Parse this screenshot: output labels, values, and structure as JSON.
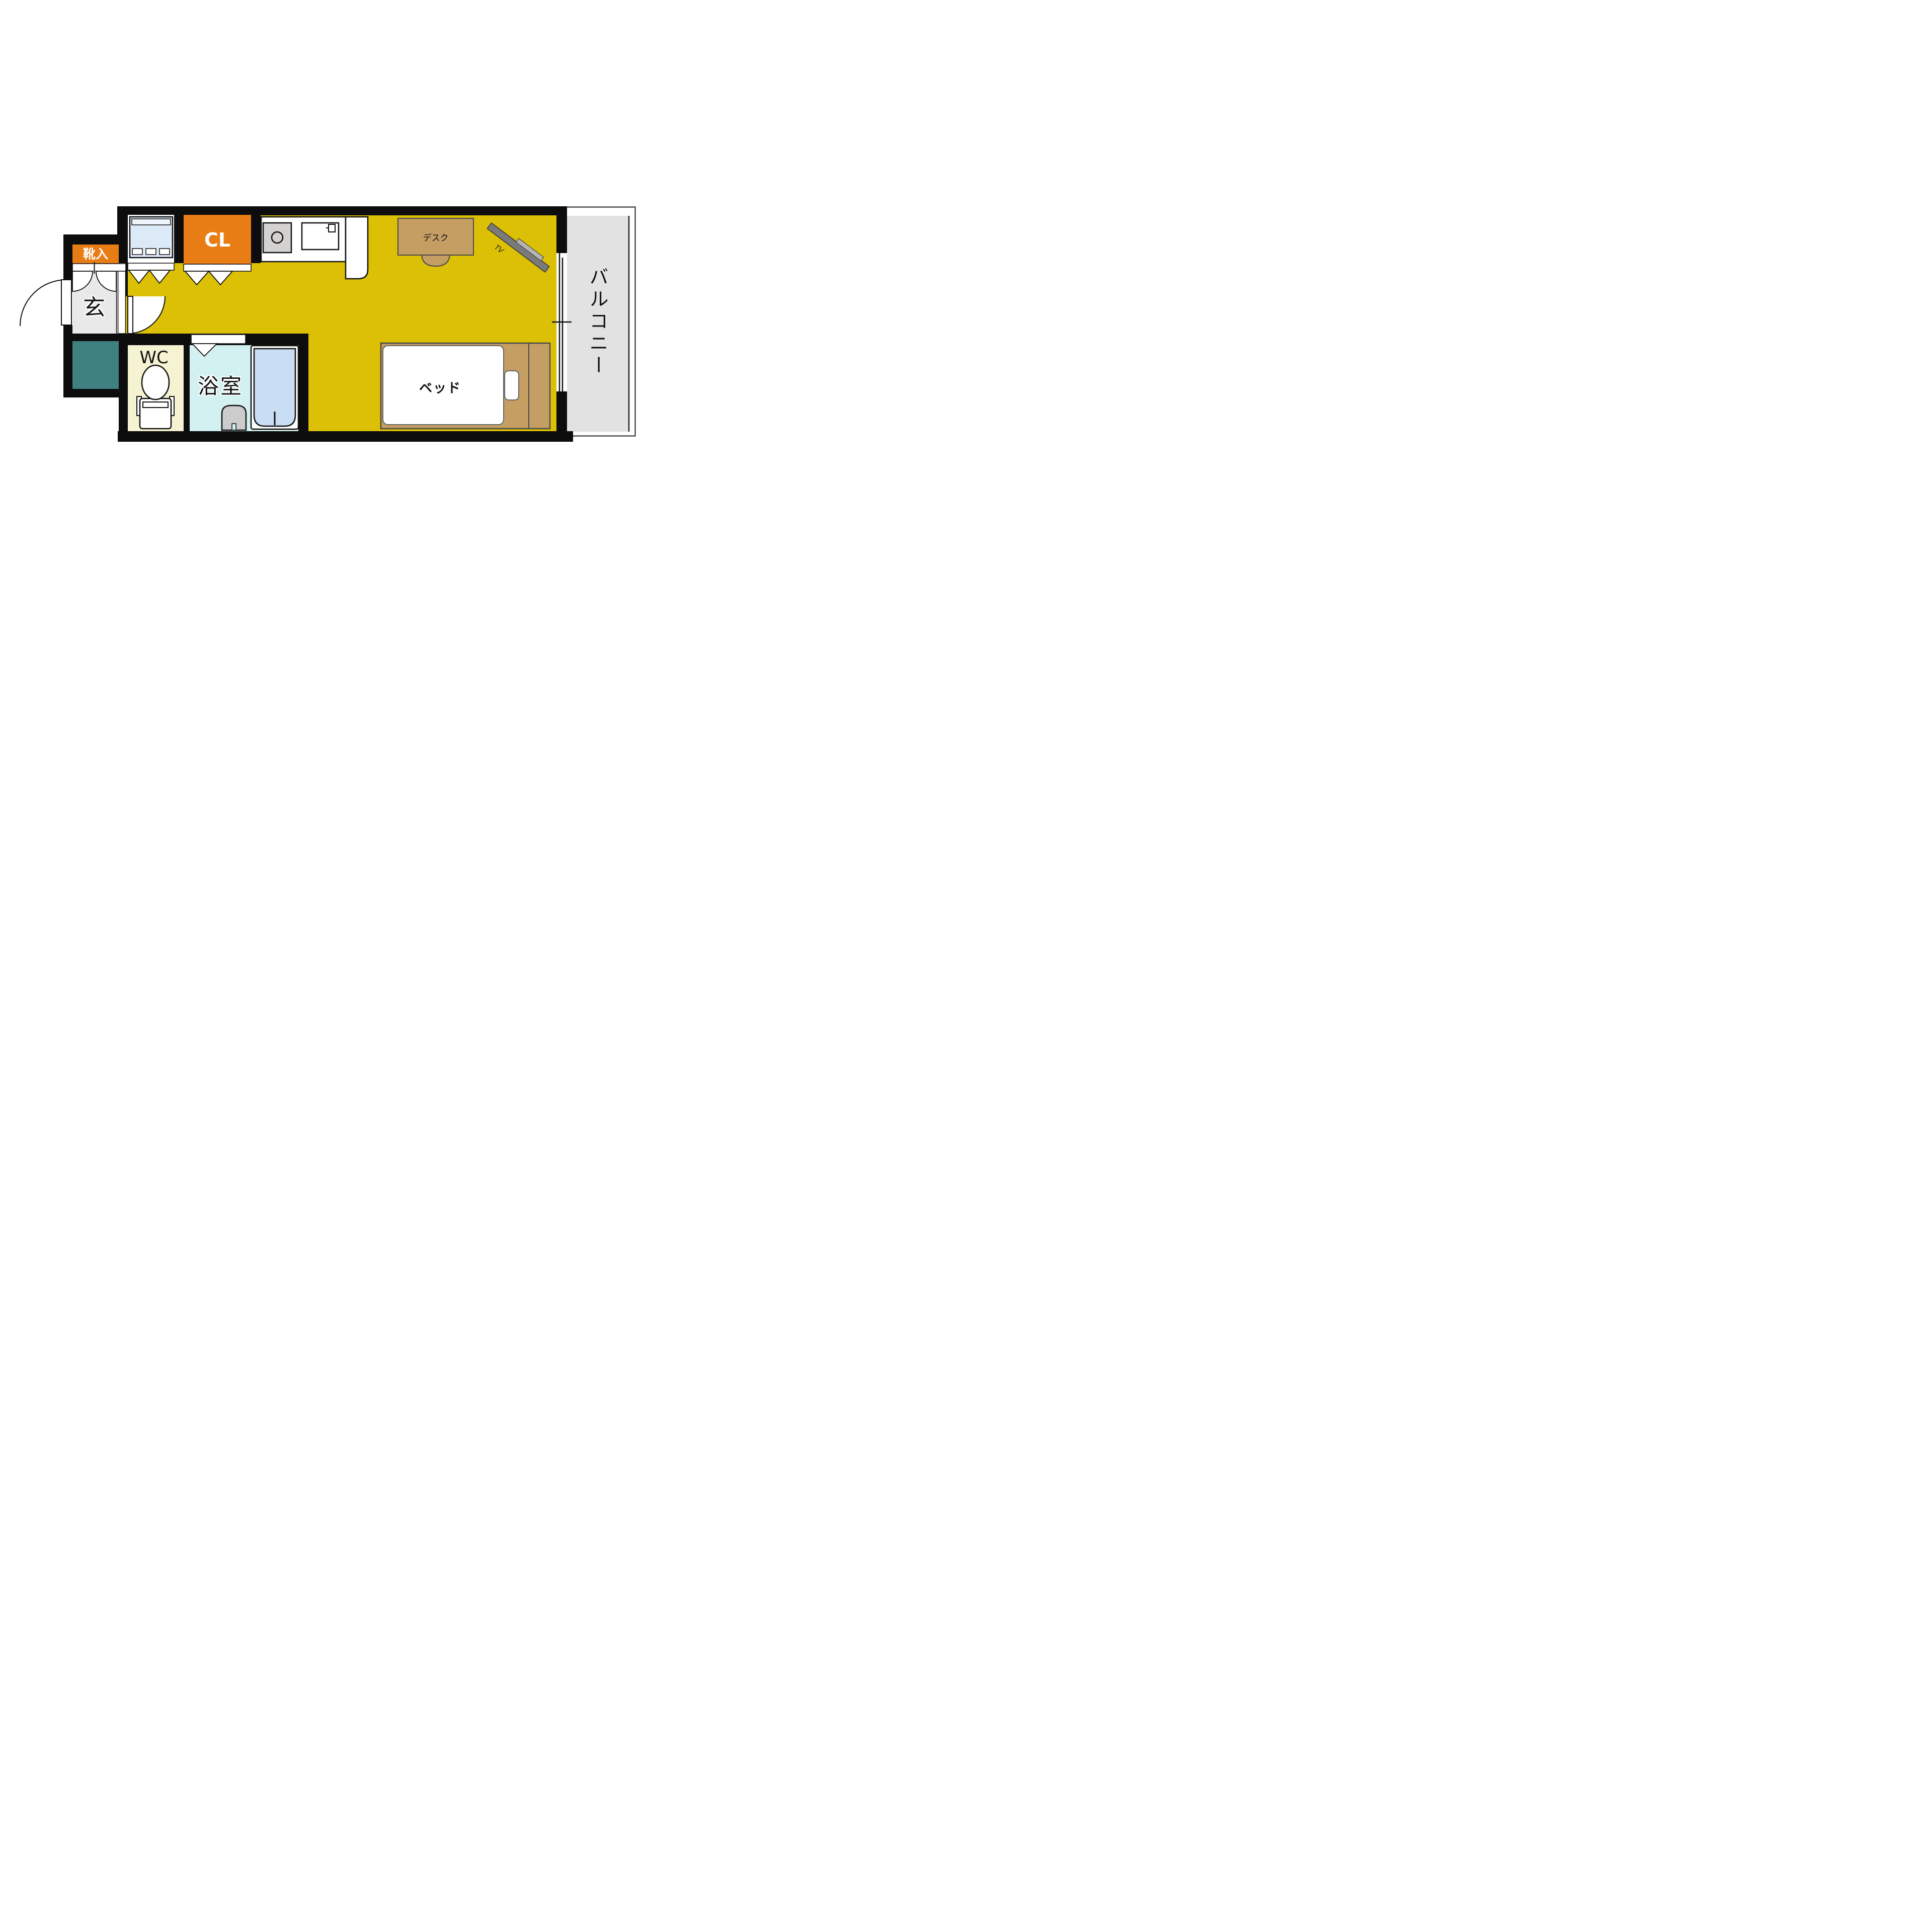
{
  "plan": {
    "title": "studio apartment floor plan",
    "rooms": {
      "shoe_cabinet_label": "靴入",
      "closet_label": "CL",
      "entrance_label": "玄",
      "toilet_label": "WC",
      "bathroom_label": "浴室",
      "bed_label": "ベッド",
      "desk_label": "デスク",
      "tv_label": "TV",
      "balcony_label": "バルコニー"
    },
    "colors": {
      "wall": "#0d0d0d",
      "main_floor": "#dcc005",
      "accent_orange": "#e87d15",
      "teal_unit": "#3f8081",
      "wc_floor": "#f6f3d3",
      "bath_floor": "#d2f1f0",
      "bathtub": "#c9ddf4",
      "wood": "#c59e63",
      "balcony_floor": "#e2e2e2",
      "entrance_floor": "#e9e9e9",
      "washer": "#dce9f7",
      "tv_dark": "#7a7a7a",
      "tv_light": "#b5b5b5"
    }
  }
}
